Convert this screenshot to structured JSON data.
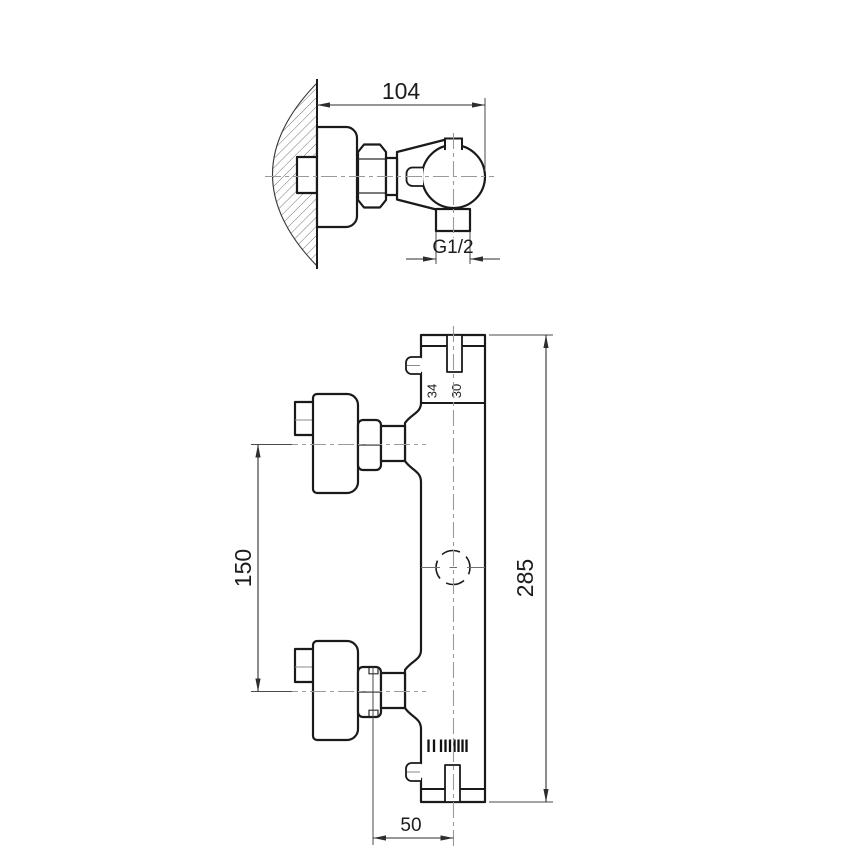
{
  "colors": {
    "background": "#ffffff",
    "outline": "#1a1a1a",
    "dimension_lines": "#2e2e2e",
    "centerlines": "#9a9a9a",
    "hatching": "#767676"
  },
  "top_view": {
    "dim_depth": "104",
    "outlet_thread": "G1/2"
  },
  "front_view": {
    "dim_height": "285",
    "dim_handle_spacing": "150",
    "dim_outlet_offset": "50",
    "cartridge_marks": {
      "left": "34",
      "right": "30"
    }
  }
}
